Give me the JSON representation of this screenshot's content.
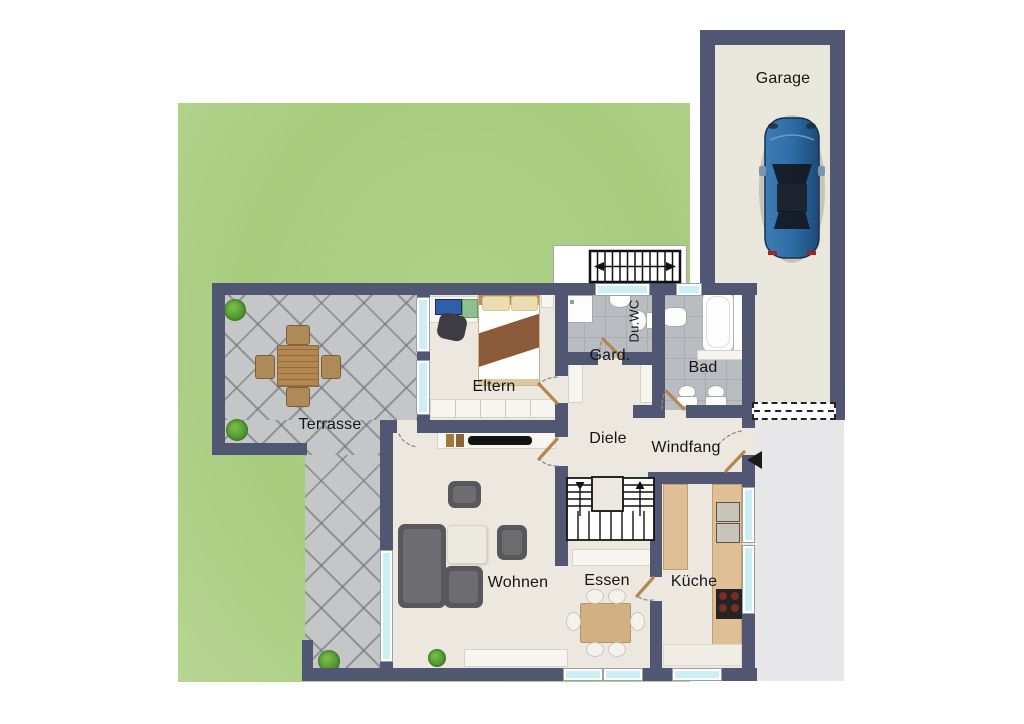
{
  "plan": {
    "type": "floor-plan",
    "labels": {
      "garage": "Garage",
      "terrasse": "Terrasse",
      "eltern": "Eltern",
      "duwc": "Du.WC",
      "gard": "Gard.",
      "bad": "Bad",
      "diele": "Diele",
      "windfang": "Windfang",
      "wohnen": "Wohnen",
      "essen": "Essen",
      "kueche": "Küche"
    },
    "colors": {
      "wall": "#515672",
      "floor": "#ece8df",
      "grass": "#a7cc7e",
      "terraceTile": "#c4c6c8",
      "bathTile": "#b9bdc1",
      "bathLine": "#a9adb2",
      "glass": "#cdeff3",
      "driveway": "#e7e7ea",
      "garageFloor": "#e9e6dc",
      "doorLeaf": "#b3874f",
      "counter": "#dfc096",
      "wood": "#d3b083",
      "sofa": "#58585c",
      "carBody": "#2e6da6",
      "white": "#ffffff"
    }
  }
}
